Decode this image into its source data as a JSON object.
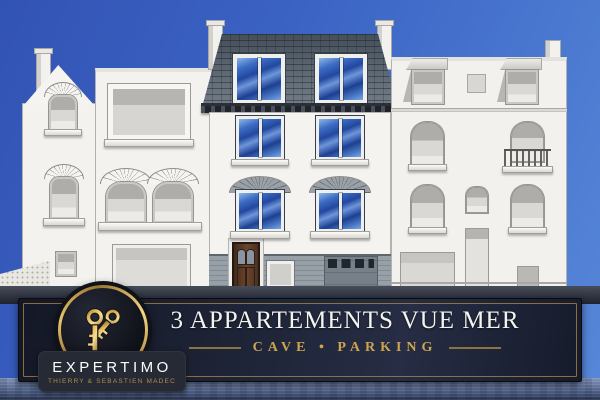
{
  "banner": {
    "title": "3 APPARTEMENTS VUE MER",
    "subtitle": "CAVE • PARKING"
  },
  "logo": {
    "brand": "EXPERTIMO",
    "tagline": "THIERRY & SEBASTIEN MADEC",
    "icon": "crossed-keys-icon"
  },
  "colors": {
    "sky_top": "#3a5fc0",
    "sky_light": "#5787d8",
    "banner_bg": "#1d2335",
    "banner_gold_frame": "#9c7f45",
    "title_text": "#f3f3f1",
    "subtitle_gold": "#cda452",
    "logo_gold": "#e8c46a",
    "badge_bg": "#262a35",
    "slate_roof": "#5d6873",
    "facade_white": "#f3f2ef",
    "window_blue": "#2c55ab",
    "siding_grey": "#949ca3",
    "door_brown": "#5c3a24",
    "water_blue": "#5c6f96"
  },
  "scene": {
    "buildings": [
      "left-white-townhouse",
      "center-slate-mansard-townhouse",
      "right-white-apartment-building"
    ]
  }
}
